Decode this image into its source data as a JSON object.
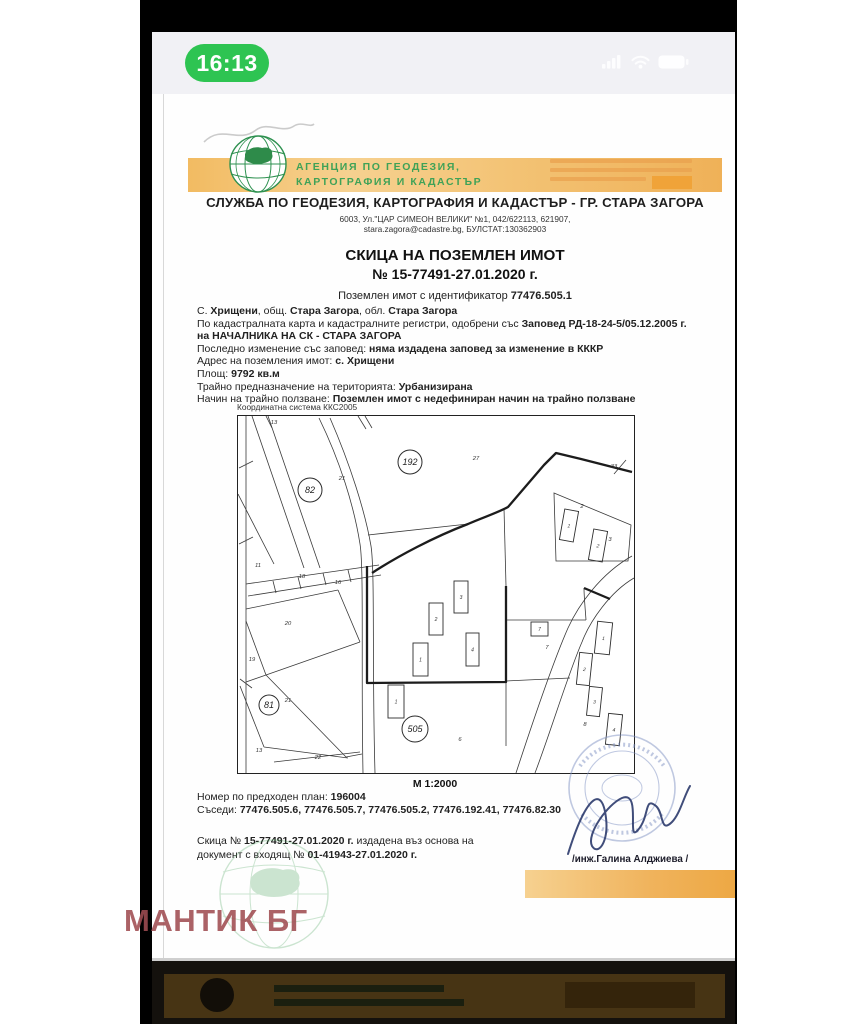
{
  "status_bar": {
    "time": "16:13"
  },
  "header": {
    "agency_line1": "АГЕНЦИЯ ПО ГЕОДЕЗИЯ,",
    "agency_line2": "КАРТОГРАФИЯ И КАДАСТЪР",
    "office_line": "СЛУЖБА ПО ГЕОДЕЗИЯ, КАРТОГРАФИЯ И КАДАСТЪР - ГР. СТАРА ЗАГОРА",
    "address_line1": "6003, Ул.\"ЦАР СИМЕОН ВЕЛИКИ\" №1, 042/622113, 621907,",
    "address_line2": "stara.zagora@cadastre.bg, БУЛСТАТ:130362903"
  },
  "title": {
    "line1": "СКИЦА НА ПОЗЕМЛЕН ИМОТ",
    "line2": "№ 15-77491-27.01.2020 г."
  },
  "identifier_runs": [
    [
      "Поземлен имот с  идентификатор ",
      false
    ],
    [
      "77476.505.1",
      true
    ]
  ],
  "info_lines": [
    [
      [
        "С. ",
        false
      ],
      [
        "Хрищени",
        true
      ],
      [
        ", общ. ",
        false
      ],
      [
        "Стара Загора",
        true
      ],
      [
        ", обл. ",
        false
      ],
      [
        "Стара Загора",
        true
      ]
    ],
    [
      [
        "По кадастралната карта и кадастралните регистри, одобрени със ",
        false
      ],
      [
        "Заповед РД-18-24-5/05.12.2005 г.",
        true
      ]
    ],
    [
      [
        "на НАЧАЛНИКА НА СК - СТАРА ЗАГОРА",
        true
      ]
    ],
    [
      [
        "Последно изменение със заповед: ",
        false
      ],
      [
        "няма издадена заповед за изменение в КККР",
        true
      ]
    ],
    [
      [
        "Адрес на поземления имот: ",
        false
      ],
      [
        "с. Хрищени",
        true
      ]
    ],
    [
      [
        "Площ: ",
        false
      ],
      [
        "9792 кв.м",
        true
      ]
    ],
    [
      [
        "Трайно предназначение на територията: ",
        false
      ],
      [
        "Урбанизирана",
        true
      ]
    ],
    [
      [
        "Начин на трайно ползване: ",
        false
      ],
      [
        "Поземлен имот с недефиниран начин на трайно ползване",
        true
      ]
    ]
  ],
  "map": {
    "coordinate_system": "Координатна система ККС2005",
    "scale": "М 1:2000",
    "parcel_circles": [
      {
        "n": "82",
        "x": 72,
        "y": 74,
        "r": 12
      },
      {
        "n": "192",
        "x": 172,
        "y": 46,
        "r": 12
      },
      {
        "n": "81",
        "x": 31,
        "y": 289,
        "r": 10
      },
      {
        "n": "505",
        "x": 177,
        "y": 313,
        "r": 13
      }
    ],
    "labels": [
      {
        "t": "13",
        "x": 36,
        "y": 8
      },
      {
        "t": "21",
        "x": 104,
        "y": 64
      },
      {
        "t": "27",
        "x": 238,
        "y": 44
      },
      {
        "t": "33",
        "x": 376,
        "y": 52
      },
      {
        "t": "11",
        "x": 20,
        "y": 151
      },
      {
        "t": "18",
        "x": 64,
        "y": 162
      },
      {
        "t": "16",
        "x": 100,
        "y": 168
      },
      {
        "t": "20",
        "x": 50,
        "y": 209
      },
      {
        "t": "19",
        "x": 14,
        "y": 245
      },
      {
        "t": "21",
        "x": 50,
        "y": 286
      },
      {
        "t": "13",
        "x": 21,
        "y": 336
      },
      {
        "t": "22",
        "x": 80,
        "y": 343
      },
      {
        "t": "7",
        "x": 309,
        "y": 233
      },
      {
        "t": "8",
        "x": 347,
        "y": 310
      },
      {
        "t": "6",
        "x": 222,
        "y": 325
      },
      {
        "t": "2",
        "x": 344,
        "y": 92
      },
      {
        "t": "3",
        "x": 372,
        "y": 125
      }
    ],
    "buildings": [
      {
        "n": "3",
        "x": 216,
        "y": 165,
        "w": 14,
        "h": 32
      },
      {
        "n": "2",
        "x": 191,
        "y": 187,
        "w": 14,
        "h": 32
      },
      {
        "n": "1",
        "x": 175,
        "y": 227,
        "w": 15,
        "h": 33
      },
      {
        "n": "4",
        "x": 228,
        "y": 217,
        "w": 13,
        "h": 33
      },
      {
        "n": "1",
        "x": 324,
        "y": 94,
        "w": 14,
        "h": 31,
        "r": 10
      },
      {
        "n": "2",
        "x": 353,
        "y": 114,
        "w": 14,
        "h": 31,
        "r": 10
      },
      {
        "n": "1",
        "x": 150,
        "y": 269,
        "w": 16,
        "h": 33
      },
      {
        "n": "7",
        "x": 293,
        "y": 206,
        "w": 17,
        "h": 14
      },
      {
        "n": "1",
        "x": 358,
        "y": 206,
        "w": 15,
        "h": 32,
        "r": 6
      },
      {
        "n": "2",
        "x": 340,
        "y": 237,
        "w": 13,
        "h": 32,
        "r": 6
      },
      {
        "n": "3",
        "x": 350,
        "y": 271,
        "w": 13,
        "h": 29,
        "r": 6
      },
      {
        "n": "4",
        "x": 369,
        "y": 298,
        "w": 14,
        "h": 31,
        "r": 6
      }
    ]
  },
  "footer": {
    "prev_plan_runs": [
      [
        "Номер по предходен план: ",
        false
      ],
      [
        "196004",
        true
      ]
    ],
    "neighbors_runs": [
      [
        "Съседи: ",
        false
      ],
      [
        "77476.505.6, 77476.505.7, 77476.505.2, 77476.192.41, 77476.82.30",
        true
      ]
    ],
    "issue_line1": [
      [
        "Скица № ",
        false
      ],
      [
        "15-77491-27.01.2020 г.",
        true
      ],
      [
        " издадена въз основа на",
        false
      ]
    ],
    "issue_line2": [
      [
        "документ с входящ № ",
        false
      ],
      [
        "01-41943-27.01.2020 г.",
        true
      ]
    ],
    "signer": "/инж.Галина Алджиева /"
  },
  "watermark": "МАНТИК БГ",
  "colors": {
    "accent_orange": "#f0b964",
    "agency_green": "#3fa257",
    "pill_green": "#2ec452",
    "watermark_red": "#a04d52",
    "stamp_blue": "#8193c4"
  }
}
